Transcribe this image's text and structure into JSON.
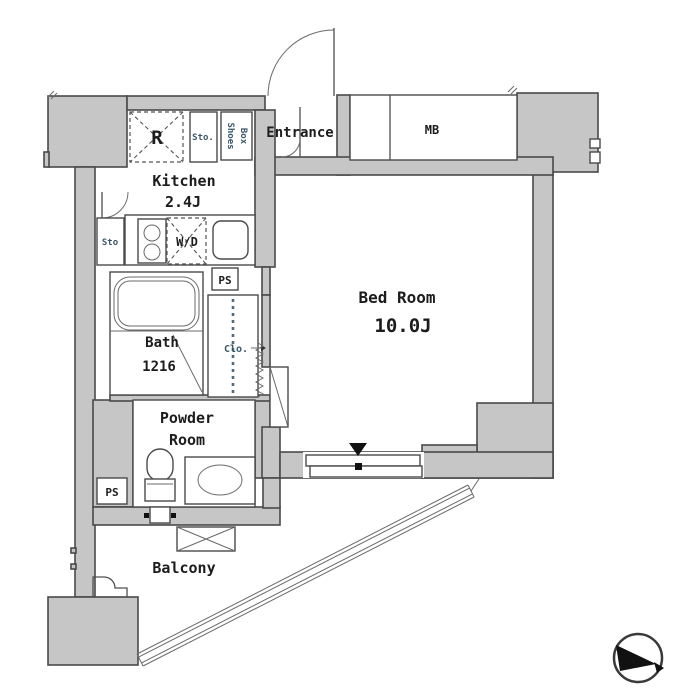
{
  "plan": {
    "labels": {
      "entrance": "Entrance",
      "kitchen_name": "Kitchen",
      "kitchen_size": "2.4J",
      "bedroom_name": "Bed Room",
      "bedroom_size": "10.0J",
      "bath_name": "Bath",
      "bath_size": "1216",
      "powder_line1": "Powder",
      "powder_line2": "Room",
      "balcony": "Balcony",
      "closet": "Clo.",
      "meter_box": "MB",
      "refrigerator": "R",
      "storage_upper": "Sto.",
      "storage_side": "Sto",
      "shoes_box_line1": "Shoes",
      "shoes_box_line2": "Box",
      "washer_dryer": "W/D",
      "pipe_space_upper": "PS",
      "pipe_space_lower": "PS"
    },
    "colors": {
      "wall_fill": "#c6c6c6",
      "storage_fill": "#d8eaf4",
      "outline": "#4a4a4a",
      "text": "#1c1c1c"
    },
    "compass": {
      "icon": "north-compass"
    }
  }
}
